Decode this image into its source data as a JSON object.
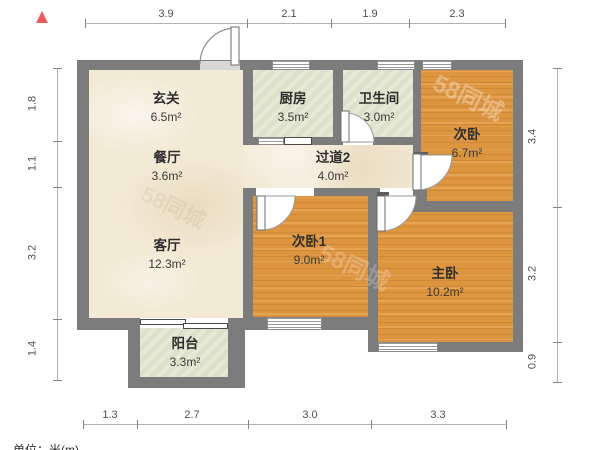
{
  "legend": {
    "unit_note": "单位：米(m)"
  },
  "dimensions_m": {
    "top": [
      "3.9",
      "2.1",
      "1.9",
      "2.3"
    ],
    "left": [
      "1.8",
      "1.1",
      "3.2",
      "1.4"
    ],
    "right": [
      "3.4",
      "3.2",
      "0.9"
    ],
    "bottom": [
      "1.3",
      "2.7",
      "3.0",
      "3.3"
    ]
  },
  "rooms": [
    {
      "name": "玄关",
      "area": "6.5m²"
    },
    {
      "name": "餐厅",
      "area": "3.6m²"
    },
    {
      "name": "客厅",
      "area": "12.3m²"
    },
    {
      "name": "阳台",
      "area": "3.3m²"
    },
    {
      "name": "厨房",
      "area": "3.5m²"
    },
    {
      "name": "卫生间",
      "area": "3.0m²"
    },
    {
      "name": "过道2",
      "area": "4.0m²"
    },
    {
      "name": "次卧",
      "area": "6.7m²"
    },
    {
      "name": "次卧1",
      "area": "9.0m²"
    },
    {
      "name": "主卧",
      "area": "10.2m²"
    }
  ],
  "watermark": {
    "text": "58同城"
  },
  "colors": {
    "wall": "#7c7c7c",
    "wood_floor": "#de9540",
    "tile_floor": "#dfe2c9",
    "marble_floor": "#f3ead6",
    "north_arrow": "#e75c5e"
  }
}
